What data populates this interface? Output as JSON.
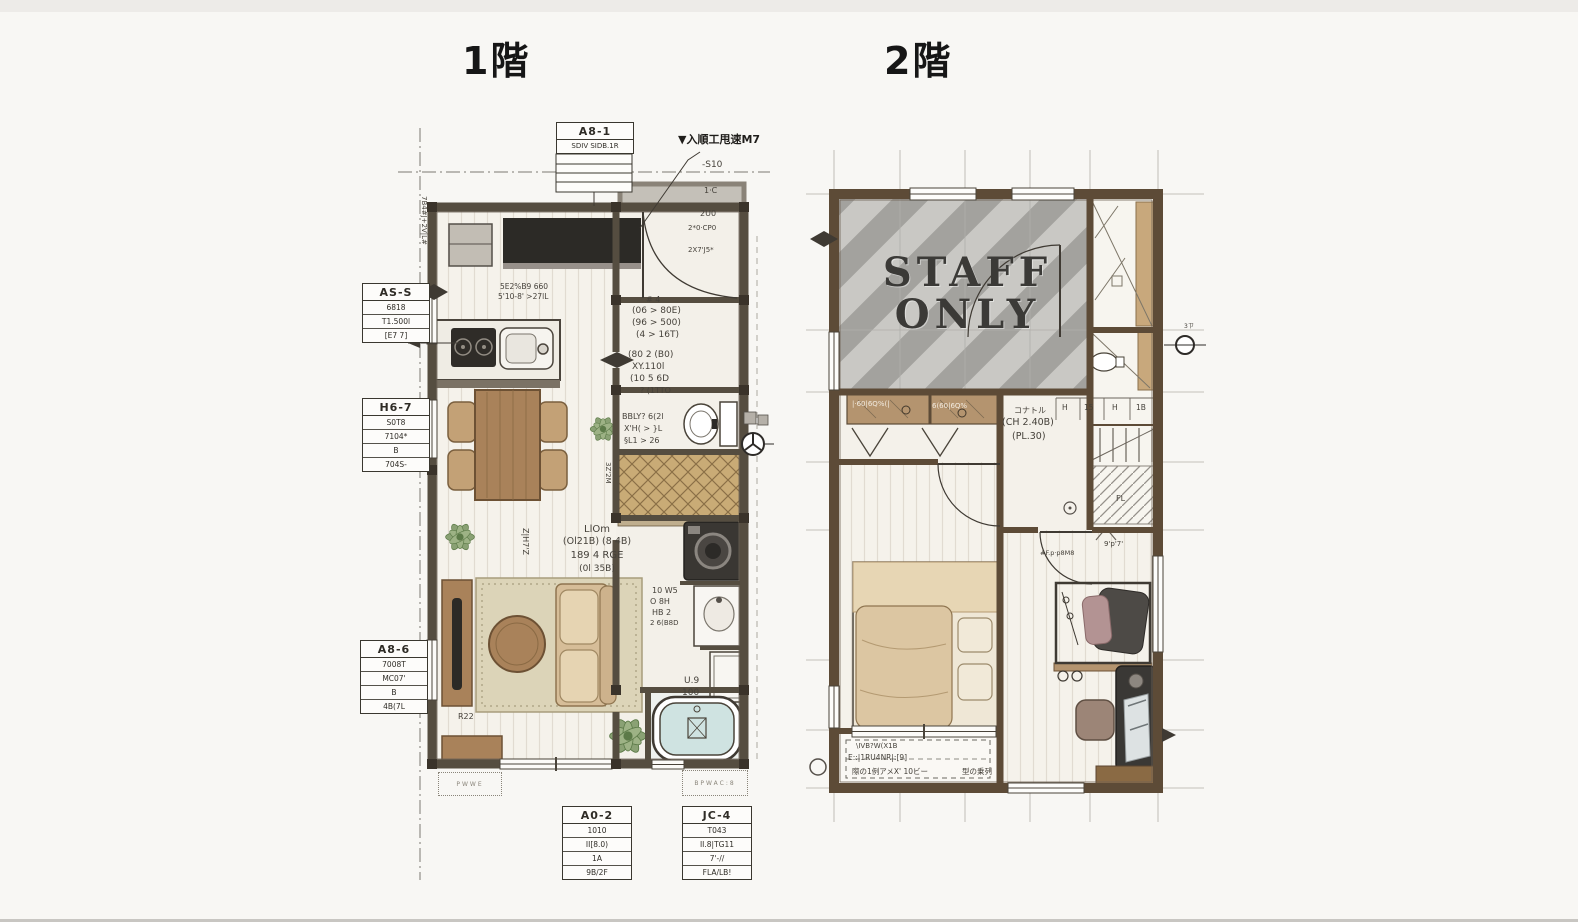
{
  "titles": {
    "floor1": "1階",
    "floor2": "2階"
  },
  "floor2_room": {
    "staff_line1": "STAFF",
    "staff_line2": "ONLY"
  },
  "labels": {
    "as1": {
      "title": "A8-1",
      "rows": [
        "SDIV SIDB.1R"
      ]
    },
    "ass": {
      "title": "AS-S",
      "rows": [
        "6818",
        "T1.500l",
        "[E7 7]"
      ]
    },
    "h67": {
      "title": "H6-7",
      "rows": [
        "S0T8",
        "7104*",
        "B",
        "704S-"
      ]
    },
    "a86": {
      "title": "A8-6",
      "rows": [
        "7008T",
        "MC07'",
        "B",
        "4B(7L"
      ]
    },
    "a02": {
      "title": "A0-2",
      "rows": [
        "1010",
        "II[8.0)",
        "1A",
        "9B/2F"
      ]
    },
    "jc4": {
      "title": "JC-4",
      "rows": [
        "T043",
        "II.8|TG11",
        "7'-//",
        "FLA/LB!"
      ]
    }
  },
  "f1": {
    "entry_note": "▼入順工甩速M7",
    "s10": "-S10",
    "porch_rows": [
      "1·C",
      "2U0",
      "2*0·CP0",
      "2X7'J5*"
    ],
    "kitchen_note1": "5E2%B9 660",
    "kitchen_note2": "5'10-8' >27lL",
    "hall_a": [
      "# 4",
      "(06 > 80E)",
      "(96 > 500)",
      "(4 > 16T)"
    ],
    "hall_b": [
      "(80 2 (B0)",
      "XY.110l",
      "(10 5 6D",
      "? (1TTO"
    ],
    "genkan_note": "3Z'2M",
    "toilet_notes": [
      "BBLY? 6(2l",
      "X'H( > }L",
      "§L1 > 26"
    ],
    "wash_notes": [
      "10 W5",
      "O 8H",
      "HB 2",
      "2 6(B8D"
    ],
    "u9": [
      "U.9",
      "100"
    ],
    "ldk": [
      "LlOm",
      "(Ol21B) (8 4B)",
      "189 4 RGE",
      "(0l 35B)"
    ],
    "tv_note": "R22",
    "vert_note": "Z|H7'Z",
    "side_note": "7B4#J+2V|L#",
    "stamp1": "PWWE",
    "stamp2": "BPWAC:8"
  },
  "f2": {
    "band1": "|·60|6Q%(|",
    "band2": "6(60|6Q%",
    "closet_note": "コナトル",
    "ch": "(CH 2.40B)",
    "pl": "(PL.30)",
    "cells": [
      "H",
      "15",
      "H",
      "1B"
    ],
    "fl": "FL",
    "stair_note": "9'p'7'",
    "wic_note": "#F.p·p8M8",
    "sym_note": "3ㄗ",
    "balcony": [
      "\\IVB?W(X1B",
      "E::|1RU4NR|:[9]",
      "際の1例アメX' 10ビー",
      "型の乗列"
    ]
  }
}
